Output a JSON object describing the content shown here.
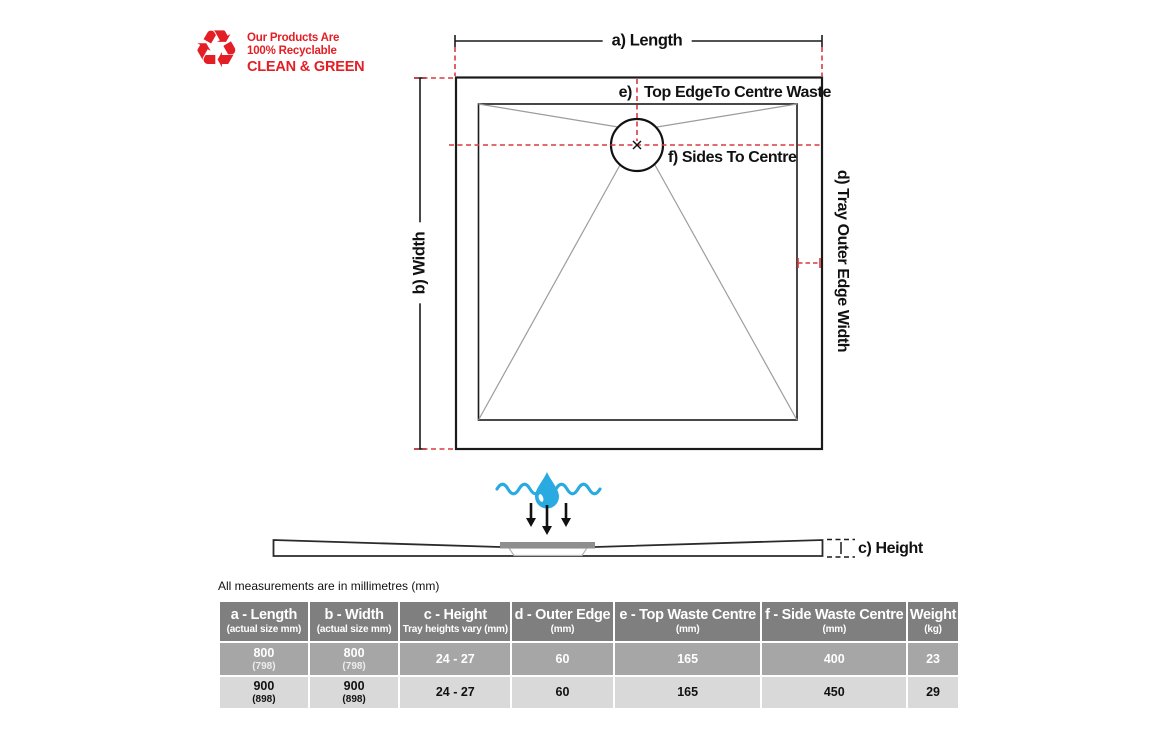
{
  "recycle": {
    "icon": "recycling-symbol-icon",
    "line1": "Our Products Are",
    "line2": "100% Recyclable",
    "line3": "CLEAN & GREEN"
  },
  "diagram": {
    "label_a": "a) Length",
    "label_b": "b) Width",
    "label_e_prefix": "e)",
    "label_e_text": "Top EdgeTo Centre Waste",
    "label_f": "f) Sides To Centre",
    "label_d": "d) Tray Outer Edge Width",
    "label_c": "c) Height"
  },
  "colors": {
    "brand_red": "#e31e24",
    "dash_red": "#d93a40",
    "water_blue": "#29abe2",
    "table_header_bg": "#7f7f7f",
    "row_odd_bg": "#a6a6a6",
    "row_even_bg": "#d9d9d9"
  },
  "note": "All measurements are in millimetres (mm)",
  "table": {
    "columns": [
      {
        "title": "a - Length",
        "subtitle": "(actual size mm)"
      },
      {
        "title": "b - Width",
        "subtitle": "(actual size mm)"
      },
      {
        "title": "c - Height",
        "subtitle": "Tray heights vary (mm)"
      },
      {
        "title": "d - Outer Edge",
        "subtitle": "(mm)"
      },
      {
        "title": "e - Top Waste Centre",
        "subtitle": "(mm)"
      },
      {
        "title": "f - Side Waste Centre",
        "subtitle": "(mm)"
      },
      {
        "title": "Weight",
        "subtitle": "(kg)"
      }
    ],
    "rows": [
      {
        "cells": [
          {
            "main": "800",
            "sub": "(798)"
          },
          {
            "main": "800",
            "sub": "(798)"
          },
          {
            "main": "24 - 27"
          },
          {
            "main": "60"
          },
          {
            "main": "165"
          },
          {
            "main": "400"
          },
          {
            "main": "23"
          }
        ]
      },
      {
        "cells": [
          {
            "main": "900",
            "sub": "(898)"
          },
          {
            "main": "900",
            "sub": "(898)"
          },
          {
            "main": "24 - 27"
          },
          {
            "main": "60"
          },
          {
            "main": "165"
          },
          {
            "main": "450"
          },
          {
            "main": "29"
          }
        ]
      }
    ]
  }
}
